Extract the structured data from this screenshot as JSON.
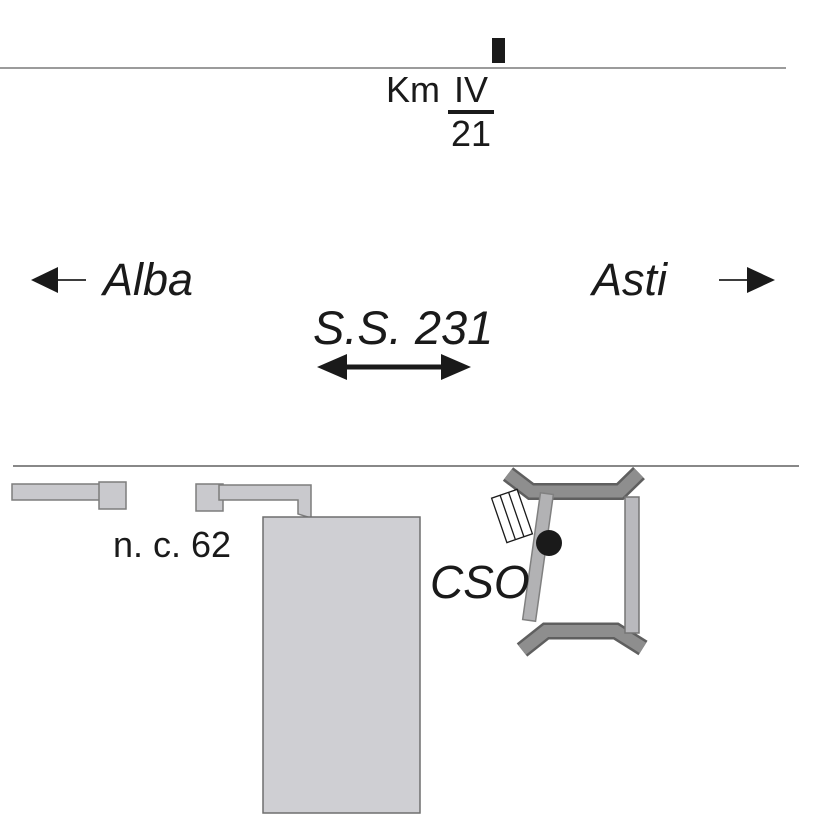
{
  "km_marker": {
    "prefix": "Km",
    "numerator": "IV",
    "denominator": "21"
  },
  "directions": {
    "west": "Alba",
    "east": "Asti"
  },
  "road": {
    "name": "S.S. 231"
  },
  "labels": {
    "house_number": "n. c. 62",
    "site": "CSO"
  },
  "colors": {
    "ink": "#1a1a1a",
    "road_line": "#9b9b9b",
    "boundary_line": "#606060",
    "building_fill": "#cfcfd3",
    "building_stroke": "#6f6f6f",
    "driveway_fill": "#c9c9cd",
    "driveway_stroke": "#7d7d7d",
    "wall_fill": "#8e8e8e",
    "wall_stroke": "#5f5f5f",
    "side_bar_fill": "#b9b9bd",
    "slanted_bar_fill": "#b2b2b4",
    "planks_fill": "#ffffff",
    "dot_fill": "#1a1a1a"
  }
}
